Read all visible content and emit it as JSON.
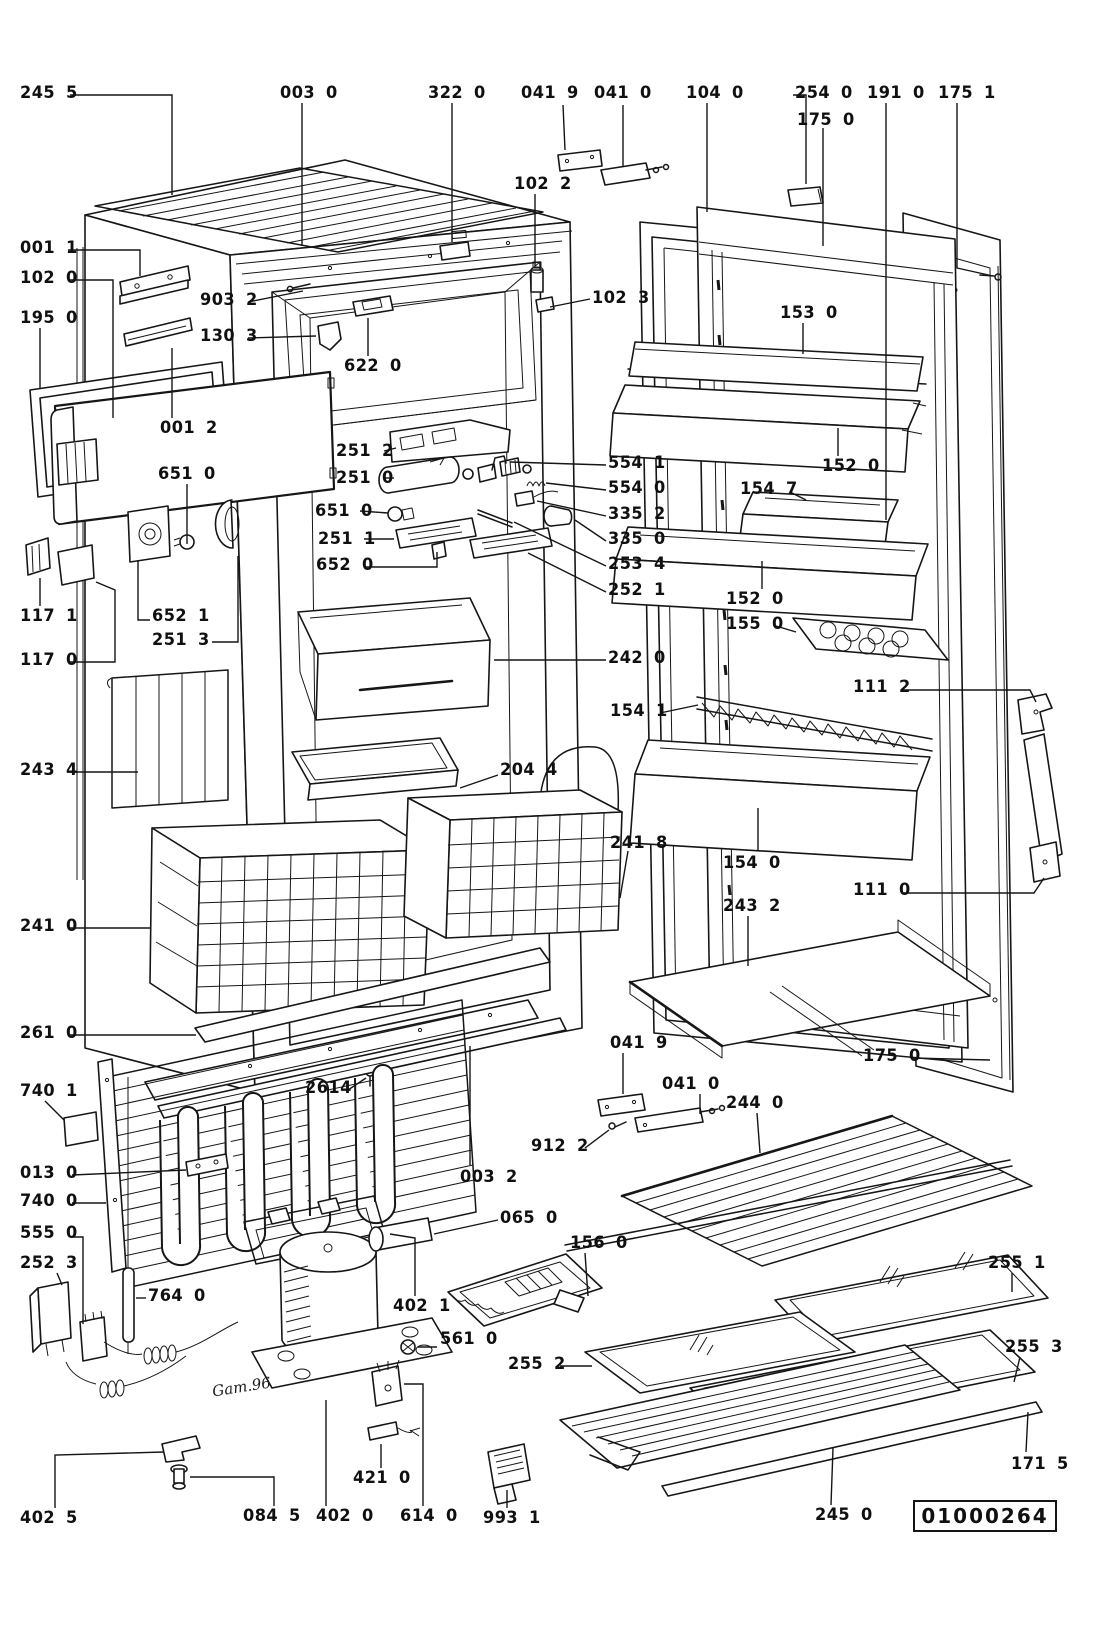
{
  "document": {
    "type": "exploded-parts-diagram",
    "subject": "refrigerator cabinet and door assembly",
    "diagram_number": "01000264",
    "handwritten_note": "Gam.96",
    "line_color": "#151515",
    "background": "#ffffff"
  },
  "labels": [
    {
      "text": "245 5",
      "x": 20,
      "y": 85,
      "leader": [
        [
          70,
          95
        ],
        [
          172,
          95
        ],
        [
          172,
          195
        ]
      ]
    },
    {
      "text": "003 0",
      "x": 280,
      "y": 85,
      "leader": [
        [
          302,
          103
        ],
        [
          302,
          246
        ]
      ]
    },
    {
      "text": "322 0",
      "x": 428,
      "y": 85,
      "leader": [
        [
          452,
          103
        ],
        [
          452,
          242
        ]
      ]
    },
    {
      "text": "041 9",
      "x": 521,
      "y": 85,
      "leader": [
        [
          563,
          105
        ],
        [
          565,
          150
        ]
      ]
    },
    {
      "text": "041 0",
      "x": 594,
      "y": 85,
      "leader": [
        [
          623,
          105
        ],
        [
          623,
          166
        ]
      ]
    },
    {
      "text": "104 0",
      "x": 686,
      "y": 85,
      "leader": [
        [
          707,
          103
        ],
        [
          707,
          212
        ]
      ]
    },
    {
      "text": "254 0",
      "x": 795,
      "y": 85,
      "leader": [
        [
          793,
          95
        ],
        [
          806,
          95
        ],
        [
          806,
          184
        ]
      ]
    },
    {
      "text": "175 0",
      "x": 797,
      "y": 112,
      "leader": [
        [
          823,
          128
        ],
        [
          823,
          246
        ]
      ]
    },
    {
      "text": "191 0",
      "x": 867,
      "y": 85,
      "leader": [
        [
          886,
          103
        ],
        [
          886,
          520
        ]
      ]
    },
    {
      "text": "175 1",
      "x": 938,
      "y": 85,
      "leader": [
        [
          957,
          103
        ],
        [
          957,
          268
        ],
        [
          993,
          276
        ]
      ]
    },
    {
      "text": "102 2",
      "x": 514,
      "y": 176,
      "leader": [
        [
          535,
          194
        ],
        [
          535,
          266
        ]
      ]
    },
    {
      "text": "102 3",
      "x": 592,
      "y": 290,
      "leader": [
        [
          590,
          299
        ],
        [
          550,
          307
        ]
      ]
    },
    {
      "text": "001 1",
      "x": 20,
      "y": 240,
      "leader": [
        [
          68,
          250
        ],
        [
          140,
          250
        ],
        [
          140,
          276
        ]
      ]
    },
    {
      "text": "102 0",
      "x": 20,
      "y": 270,
      "leader": [
        [
          68,
          280
        ],
        [
          113,
          280
        ],
        [
          113,
          418
        ]
      ]
    },
    {
      "text": "195 0",
      "x": 20,
      "y": 310,
      "leader": [
        [
          40,
          328
        ],
        [
          40,
          388
        ]
      ]
    },
    {
      "text": "903 2",
      "x": 200,
      "y": 292,
      "leader": [
        [
          248,
          302
        ],
        [
          303,
          291
        ]
      ]
    },
    {
      "text": "130 3",
      "x": 200,
      "y": 328,
      "leader": [
        [
          248,
          338
        ],
        [
          316,
          336
        ]
      ]
    },
    {
      "text": "622 0",
      "x": 344,
      "y": 358,
      "leader": [
        [
          368,
          356
        ],
        [
          368,
          318
        ]
      ]
    },
    {
      "text": "001 2",
      "x": 160,
      "y": 420,
      "leader": [
        [
          172,
          418
        ],
        [
          172,
          348
        ]
      ]
    },
    {
      "text": "651 0",
      "x": 158,
      "y": 466,
      "leader": [
        [
          187,
          484
        ],
        [
          187,
          544
        ]
      ]
    },
    {
      "text": "251 2",
      "x": 336,
      "y": 443,
      "leader": [
        [
          384,
          451
        ],
        [
          396,
          448
        ]
      ]
    },
    {
      "text": "251 0",
      "x": 336,
      "y": 470,
      "leader": [
        [
          384,
          478
        ],
        [
          394,
          478
        ]
      ]
    },
    {
      "text": "651 0",
      "x": 315,
      "y": 503,
      "leader": [
        [
          360,
          511
        ],
        [
          388,
          513
        ]
      ]
    },
    {
      "text": "251 1",
      "x": 318,
      "y": 531,
      "leader": [
        [
          364,
          539
        ],
        [
          394,
          539
        ]
      ]
    },
    {
      "text": "652 0",
      "x": 316,
      "y": 557,
      "leader": [
        [
          364,
          567
        ],
        [
          437,
          567
        ],
        [
          437,
          552
        ]
      ]
    },
    {
      "text": "554 1",
      "x": 608,
      "y": 455,
      "leader": [
        [
          606,
          465
        ],
        [
          510,
          462
        ]
      ]
    },
    {
      "text": "554 0",
      "x": 608,
      "y": 480,
      "leader": [
        [
          606,
          490
        ],
        [
          546,
          483
        ]
      ]
    },
    {
      "text": "335 2",
      "x": 608,
      "y": 506,
      "leader": [
        [
          606,
          516
        ],
        [
          537,
          501
        ]
      ]
    },
    {
      "text": "335 0",
      "x": 608,
      "y": 531,
      "leader": [
        [
          606,
          541
        ],
        [
          575,
          520
        ]
      ]
    },
    {
      "text": "253 4",
      "x": 608,
      "y": 556,
      "leader": [
        [
          606,
          566
        ],
        [
          514,
          522
        ]
      ]
    },
    {
      "text": "252 1",
      "x": 608,
      "y": 582,
      "leader": [
        [
          606,
          592
        ],
        [
          528,
          553
        ]
      ]
    },
    {
      "text": "242 0",
      "x": 608,
      "y": 650,
      "leader": [
        [
          606,
          660
        ],
        [
          494,
          660
        ]
      ]
    },
    {
      "text": "117 1",
      "x": 20,
      "y": 608,
      "leader": [
        [
          40,
          606
        ],
        [
          40,
          578
        ]
      ]
    },
    {
      "text": "117 0",
      "x": 20,
      "y": 652,
      "leader": [
        [
          68,
          662
        ],
        [
          115,
          662
        ],
        [
          115,
          590
        ],
        [
          96,
          582
        ]
      ]
    },
    {
      "text": "652 1",
      "x": 152,
      "y": 608,
      "leader": [
        [
          150,
          620
        ],
        [
          138,
          620
        ],
        [
          138,
          560
        ]
      ]
    },
    {
      "text": "251 3",
      "x": 152,
      "y": 632,
      "leader": [
        [
          212,
          642
        ],
        [
          238,
          642
        ],
        [
          238,
          556
        ]
      ]
    },
    {
      "text": "243 4",
      "x": 20,
      "y": 762,
      "leader": [
        [
          70,
          772
        ],
        [
          138,
          772
        ]
      ]
    },
    {
      "text": "204 4",
      "x": 500,
      "y": 762,
      "leader": [
        [
          498,
          775
        ],
        [
          460,
          788
        ]
      ]
    },
    {
      "text": "241 0",
      "x": 20,
      "y": 918,
      "leader": [
        [
          70,
          928
        ],
        [
          150,
          928
        ]
      ]
    },
    {
      "text": "261 0",
      "x": 20,
      "y": 1025,
      "leader": [
        [
          70,
          1035
        ],
        [
          196,
          1035
        ]
      ]
    },
    {
      "text": "2614",
      "x": 305,
      "y": 1080,
      "leader": [
        [
          348,
          1090
        ],
        [
          366,
          1078
        ]
      ]
    },
    {
      "text": "153 0",
      "x": 780,
      "y": 305,
      "leader": [
        [
          803,
          323
        ],
        [
          803,
          354
        ]
      ]
    },
    {
      "text": "152 0",
      "x": 822,
      "y": 458,
      "leader": [
        [
          838,
          456
        ],
        [
          838,
          428
        ]
      ]
    },
    {
      "text": "154 7",
      "x": 740,
      "y": 481,
      "leader": [
        [
          790,
          492
        ],
        [
          806,
          500
        ]
      ]
    },
    {
      "text": "152 0",
      "x": 726,
      "y": 591,
      "leader": [
        [
          762,
          589
        ],
        [
          762,
          561
        ]
      ]
    },
    {
      "text": "155 0",
      "x": 726,
      "y": 616,
      "leader": [
        [
          776,
          626
        ],
        [
          796,
          632
        ]
      ]
    },
    {
      "text": "111 2",
      "x": 853,
      "y": 679,
      "leader": [
        [
          903,
          690
        ],
        [
          1030,
          690
        ],
        [
          1036,
          702
        ]
      ]
    },
    {
      "text": "154 1",
      "x": 610,
      "y": 703,
      "leader": [
        [
          660,
          713
        ],
        [
          698,
          705
        ]
      ]
    },
    {
      "text": "241 8",
      "x": 610,
      "y": 835,
      "leader": [
        [
          628,
          851
        ],
        [
          620,
          898
        ]
      ]
    },
    {
      "text": "154 0",
      "x": 723,
      "y": 855,
      "leader": [
        [
          758,
          851
        ],
        [
          758,
          808
        ]
      ]
    },
    {
      "text": "111 0",
      "x": 853,
      "y": 882,
      "leader": [
        [
          903,
          893
        ],
        [
          1034,
          893
        ],
        [
          1044,
          878
        ]
      ]
    },
    {
      "text": "243 2",
      "x": 723,
      "y": 898,
      "leader": [
        [
          748,
          916
        ],
        [
          748,
          966
        ]
      ]
    },
    {
      "text": "175 0",
      "x": 863,
      "y": 1048,
      "leader": [
        [
          911,
          1058
        ],
        [
          990,
          1060
        ]
      ]
    },
    {
      "text": "041 9",
      "x": 610,
      "y": 1035,
      "leader": [
        [
          623,
          1053
        ],
        [
          623,
          1094
        ]
      ]
    },
    {
      "text": "041 0",
      "x": 662,
      "y": 1076,
      "leader": [
        [
          700,
          1094
        ],
        [
          700,
          1114
        ]
      ]
    },
    {
      "text": "244 0",
      "x": 726,
      "y": 1095,
      "leader": [
        [
          757,
          1113
        ],
        [
          760,
          1153
        ]
      ]
    },
    {
      "text": "912 2",
      "x": 531,
      "y": 1138,
      "leader": [
        [
          585,
          1148
        ],
        [
          609,
          1130
        ]
      ]
    },
    {
      "text": "003 2",
      "x": 460,
      "y": 1169,
      "leader": [
        [
          470,
          1165
        ],
        [
          470,
          1046
        ]
      ]
    },
    {
      "text": "065 0",
      "x": 500,
      "y": 1210,
      "leader": [
        [
          498,
          1220
        ],
        [
          434,
          1234
        ]
      ]
    },
    {
      "text": "156 0",
      "x": 570,
      "y": 1235,
      "leader": [
        [
          585,
          1253
        ],
        [
          588,
          1296
        ]
      ]
    },
    {
      "text": "255 1",
      "x": 988,
      "y": 1255,
      "leader": [
        [
          1012,
          1273
        ],
        [
          1012,
          1292
        ]
      ]
    },
    {
      "text": "255 2",
      "x": 508,
      "y": 1356,
      "leader": [
        [
          560,
          1366
        ],
        [
          592,
          1366
        ]
      ]
    },
    {
      "text": "255 3",
      "x": 1005,
      "y": 1339,
      "leader": [
        [
          1020,
          1357
        ],
        [
          1014,
          1382
        ]
      ]
    },
    {
      "text": "171 5",
      "x": 1011,
      "y": 1456,
      "leader": [
        [
          1026,
          1452
        ],
        [
          1028,
          1412
        ]
      ]
    },
    {
      "text": "245 0",
      "x": 815,
      "y": 1507,
      "leader": [
        [
          831,
          1505
        ],
        [
          833,
          1448
        ]
      ]
    },
    {
      "text": "740 1",
      "x": 20,
      "y": 1083,
      "leader": [
        [
          45,
          1101
        ],
        [
          64,
          1120
        ]
      ]
    },
    {
      "text": "013 0",
      "x": 20,
      "y": 1165,
      "leader": [
        [
          72,
          1175
        ],
        [
          186,
          1170
        ]
      ]
    },
    {
      "text": "740 0",
      "x": 20,
      "y": 1193,
      "leader": [
        [
          72,
          1203
        ],
        [
          106,
          1203
        ]
      ]
    },
    {
      "text": "555 0",
      "x": 20,
      "y": 1225,
      "leader": [
        [
          72,
          1237
        ],
        [
          83,
          1237
        ],
        [
          83,
          1324
        ]
      ]
    },
    {
      "text": "252 3",
      "x": 20,
      "y": 1255,
      "leader": [
        [
          57,
          1273
        ],
        [
          62,
          1285
        ]
      ]
    },
    {
      "text": "764 0",
      "x": 148,
      "y": 1288,
      "leader": [
        [
          146,
          1298
        ],
        [
          136,
          1298
        ]
      ]
    },
    {
      "text": "402 1",
      "x": 393,
      "y": 1298,
      "leader": [
        [
          415,
          1296
        ],
        [
          415,
          1238
        ],
        [
          390,
          1234
        ]
      ]
    },
    {
      "text": "561 0",
      "x": 440,
      "y": 1331,
      "leader": [
        [
          437,
          1347
        ],
        [
          418,
          1347
        ]
      ]
    },
    {
      "text": "402 5",
      "x": 20,
      "y": 1510,
      "leader": [
        [
          55,
          1508
        ],
        [
          55,
          1455
        ],
        [
          164,
          1452
        ]
      ]
    },
    {
      "text": "084 5",
      "x": 243,
      "y": 1508,
      "leader": [
        [
          274,
          1506
        ],
        [
          274,
          1477
        ],
        [
          190,
          1477
        ]
      ]
    },
    {
      "text": "402 0",
      "x": 316,
      "y": 1508,
      "leader": [
        [
          326,
          1506
        ],
        [
          326,
          1400
        ]
      ]
    },
    {
      "text": "421 0",
      "x": 353,
      "y": 1470,
      "leader": [
        [
          381,
          1468
        ],
        [
          381,
          1444
        ]
      ]
    },
    {
      "text": "614 0",
      "x": 400,
      "y": 1508,
      "leader": [
        [
          423,
          1506
        ],
        [
          423,
          1384
        ],
        [
          404,
          1384
        ]
      ]
    },
    {
      "text": "993 1",
      "x": 483,
      "y": 1510,
      "leader": [
        [
          507,
          1508
        ],
        [
          507,
          1490
        ]
      ]
    }
  ]
}
